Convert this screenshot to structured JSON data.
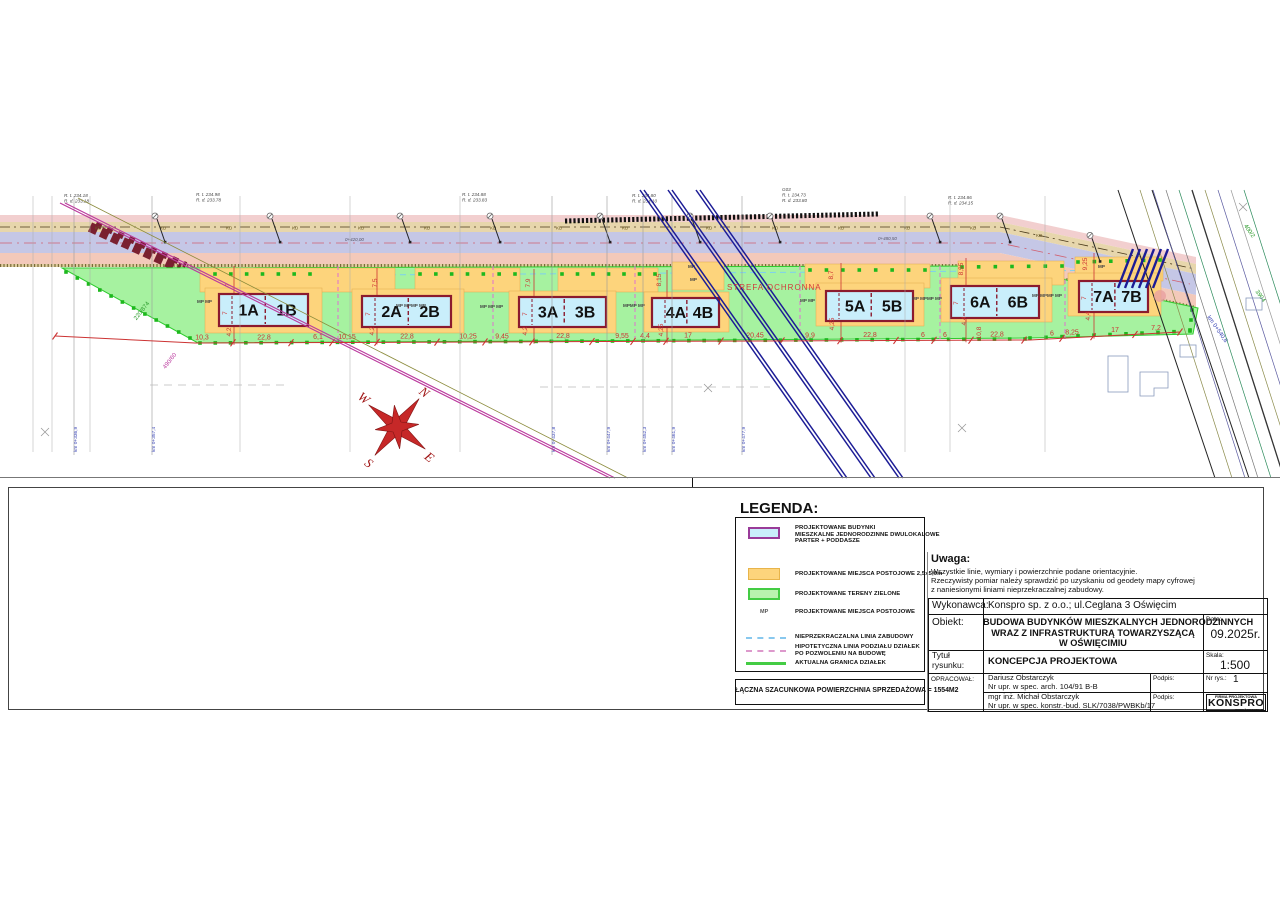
{
  "uwaga": {
    "title": "Uwaga:",
    "l1": "Wszystkie linie, wymiary i powierzchnie podane orientacyjnie.",
    "l2": "Rzeczywisty pomiar należy sprawdzić po uzyskaniu od geodety mapy cyfrowej",
    "l3": "z naniesionymi liniami nieprzekraczalnej zabudowy."
  },
  "legend": {
    "title": "LEGENDA:",
    "item1": {
      "l1": "PROJEKTOWANE BUDYNKI",
      "l2": "MIESZKALNE JEDNORODZINNE DWULOKALOWE",
      "l3": "PARTER + PODDASZE"
    },
    "item2": "PROJEKTOWANE MIEJSCA POSTOJOWE 2,5x5,0m",
    "item3": "PROJEKTOWANE TERENY ZIELONE",
    "mp_symbol": "MP",
    "item4": "PROJEKTOWANE MIEJSCA POSTOJOWE",
    "item5": "NIEPRZEKRACZALNA LINIA ZABUDOWY",
    "item6l1": "HIPOTETYCZNA LINIA PODZIAŁU DZIAŁEK",
    "item6l2": "PO POZWOLENIU NA BUDOWĘ",
    "item7": "AKTUALNA GRANICA DZIAŁEK",
    "sum": "ŁĄCZNA SZACUNKOWA POWIERZCHNIA SPRZEDAŻOWA = 1554M2",
    "colors": {
      "building": "#c9eefb",
      "building_border": "#993b99",
      "parking": "#fdd47c",
      "green": "#b9f2ae"
    }
  },
  "tb": {
    "wykonawca_label": "Wykonawca:",
    "wykonawca_value": "Konspro sp. z o.o.; ul.Ceglana 3 Oświęcim",
    "obiekt_label": "Obiekt:",
    "obiekt_lines": [
      "BUDOWA BUDYNKÓW MIESZKALNYCH JEDNORODZINNYCH",
      "WRAZ Z INFRASTRUKTURĄ TOWARZYSZĄCĄ",
      "W OŚWIĘCIMIU"
    ],
    "data_label": "Data:",
    "data_value": "09.2025r.",
    "tytul_label_1": "Tytuł",
    "tytul_label_2": "rysunku:",
    "tytul_value": "KONCEPCJA PROJEKTOWA",
    "skala_label": "Skala:",
    "skala_value": "1:500",
    "opracowal_label": "OPRACOWAŁ:",
    "author1_name": "Dariusz Obstarczyk",
    "author1_upr": "Nr upr. w spec. arch. 104/91 B-B",
    "author2_name": "mgr inż. Michał Obstarczyk",
    "author2_upr": "Nr upr. w spec. konstr.-bud. SLK/7038/PWBKb/17",
    "podpis_label": "Podpis:",
    "nr_rys_label": "Nr rys.:",
    "nr_rys_value": "1",
    "logo_top": "FIRMA PROJEKTOWA",
    "logo_name": "KONSPRO",
    "logo_site": "www.konspro.pl"
  },
  "plan": {
    "labels": {
      "strefa": "STREFA OCHRONNA"
    },
    "compass": {
      "n": "N",
      "e": "E",
      "s": "S",
      "w": "W"
    },
    "kd_label": "KD",
    "kd_xs": [
      95,
      160,
      226,
      292,
      358,
      424,
      490,
      556,
      622,
      706,
      772,
      838,
      904,
      970,
      1036
    ],
    "dim_chain": [
      {
        "t": "10,3",
        "x": 202
      },
      {
        "t": "22,8",
        "x": 264
      },
      {
        "t": "6,1",
        "x": 318
      },
      {
        "t": "10,15",
        "x": 347
      },
      {
        "t": "22,8",
        "x": 407
      },
      {
        "t": "10,25",
        "x": 468
      },
      {
        "t": "9,45",
        "x": 502
      },
      {
        "t": "22,8",
        "x": 563
      },
      {
        "t": "9,55",
        "x": 622
      },
      {
        "t": "4,4",
        "x": 645
      },
      {
        "t": "17",
        "x": 688
      },
      {
        "t": "20,45",
        "x": 755
      },
      {
        "t": "9,9",
        "x": 810
      },
      {
        "t": "22,8",
        "x": 870
      },
      {
        "t": "6",
        "x": 923
      },
      {
        "t": "6",
        "x": 945
      },
      {
        "t": "22,8",
        "x": 997
      },
      {
        "t": "6",
        "x": 1052
      },
      {
        "t": "8,25",
        "x": 1072
      },
      {
        "t": "17",
        "x": 1115
      },
      {
        "t": "7,2",
        "x": 1156
      }
    ],
    "dim_ticks": [
      55,
      233,
      291,
      332,
      377,
      437,
      485,
      532,
      592,
      633,
      666,
      721,
      782,
      840,
      896,
      934,
      971,
      1024,
      1062,
      1093,
      1135,
      1180
    ],
    "vert_dims": [
      {
        "t": "7",
        "x": 230,
        "y": 285
      },
      {
        "t": "4,2",
        "x": 231,
        "y": 332
      },
      {
        "t": "7",
        "x": 227,
        "y": 313
      },
      {
        "t": "7,5",
        "x": 377,
        "y": 283
      },
      {
        "t": "4,2",
        "x": 374,
        "y": 331
      },
      {
        "t": "7",
        "x": 370,
        "y": 314
      },
      {
        "t": "7,9",
        "x": 530,
        "y": 283
      },
      {
        "t": "4,2",
        "x": 527,
        "y": 331
      },
      {
        "t": "7",
        "x": 527,
        "y": 314
      },
      {
        "t": "8,15",
        "x": 661,
        "y": 280
      },
      {
        "t": "4,25",
        "x": 663,
        "y": 330
      },
      {
        "t": "8,7",
        "x": 833,
        "y": 275
      },
      {
        "t": "4,25",
        "x": 834,
        "y": 324
      },
      {
        "t": "8,95",
        "x": 963,
        "y": 269
      },
      {
        "t": "4,4",
        "x": 966,
        "y": 321
      },
      {
        "t": "10,8",
        "x": 981,
        "y": 333
      },
      {
        "t": "7",
        "x": 958,
        "y": 303
      },
      {
        "t": "9,25",
        "x": 1087,
        "y": 264
      },
      {
        "t": "4,4",
        "x": 1090,
        "y": 316
      },
      {
        "t": "7",
        "x": 1086,
        "y": 298
      }
    ],
    "mp_labels": [
      {
        "t": "MP MP",
        "x": 197,
        "y": 303
      },
      {
        "t": "MP MPMP MP",
        "x": 396,
        "y": 307
      },
      {
        "t": "MP MP MP",
        "x": 480,
        "y": 308
      },
      {
        "t": "MPMP MP",
        "x": 623,
        "y": 307
      },
      {
        "t": "MP",
        "x": 688,
        "y": 268
      },
      {
        "t": "MP",
        "x": 690,
        "y": 281
      },
      {
        "t": "MP MP",
        "x": 800,
        "y": 302
      },
      {
        "t": "MP MPMP MP",
        "x": 912,
        "y": 300
      },
      {
        "t": "MP MPMP MP",
        "x": 1032,
        "y": 297
      },
      {
        "t": "MP",
        "x": 1098,
        "y": 268
      }
    ],
    "buildings": [
      {
        "a": "1A",
        "b": "1B",
        "x": 219,
        "y": 294,
        "w": 89,
        "h": 32
      },
      {
        "a": "2A",
        "b": "2B",
        "x": 362,
        "y": 296,
        "w": 89,
        "h": 31
      },
      {
        "a": "3A",
        "b": "3B",
        "x": 519,
        "y": 297,
        "w": 87,
        "h": 30
      },
      {
        "a": "4A",
        "b": "4B",
        "x": 652,
        "y": 298,
        "w": 67,
        "h": 29
      },
      {
        "a": "5A",
        "b": "5B",
        "x": 826,
        "y": 291,
        "w": 87,
        "h": 30
      },
      {
        "a": "6A",
        "b": "6B",
        "x": 951,
        "y": 286,
        "w": 88,
        "h": 32
      },
      {
        "a": "7A",
        "b": "7B",
        "x": 1079,
        "y": 281,
        "w": 69,
        "h": 31
      }
    ],
    "pink_dividers": [
      338,
      493,
      635,
      800,
      940,
      1065
    ],
    "survey_points": [
      155,
      270,
      400,
      490,
      600,
      690,
      770,
      930,
      1000,
      1090
    ],
    "survey_labels": [
      {
        "x": 64,
        "y": 197,
        "lines": [
          "R. t. 234.18",
          "R. d. 233.18"
        ]
      },
      {
        "x": 196,
        "y": 196,
        "lines": [
          "R. t. 234.98",
          "R. d. 233.78"
        ]
      },
      {
        "x": 462,
        "y": 196,
        "lines": [
          "R. t. 234.88",
          "R. d. 233.83"
        ]
      },
      {
        "x": 632,
        "y": 197,
        "lines": [
          "R. t. 234.80",
          "R. d. 234.10"
        ]
      },
      {
        "x": 782,
        "y": 191,
        "lines": [
          "G03",
          "R. t. 234.73",
          "R. d. 233.80"
        ]
      },
      {
        "x": 948,
        "y": 199,
        "lines": [
          "R. t. 234.86",
          "R. d. 234.15"
        ]
      }
    ],
    "station_labels": [
      {
        "t": "0+420,00",
        "x": 345,
        "y": 241
      },
      {
        "t": "0+480,50",
        "x": 878,
        "y": 240
      }
    ],
    "km_sections": [
      {
        "t": "km 0+336,9",
        "x": 74
      },
      {
        "t": "km 0+357,4",
        "x": 152
      },
      {
        "t": "km 0+437,8",
        "x": 552
      },
      {
        "t": "km 0+447,9",
        "x": 607
      },
      {
        "t": "km 0+452,3",
        "x": 643
      },
      {
        "t": "km 0+461,9",
        "x": 672
      },
      {
        "t": "km 0+477,9",
        "x": 742
      }
    ],
    "plain_sections": [
      33,
      52,
      90,
      240,
      350,
      460,
      905,
      950,
      1045
    ],
    "parcel_labels": [
      {
        "t": "220/874",
        "x": 143,
        "y": 312,
        "r": -52,
        "c": "#2a9a2a"
      },
      {
        "t": "490/60",
        "x": 171,
        "y": 362,
        "r": -52,
        "c": "#bb3a9e"
      },
      {
        "t": "400/2",
        "x": 1248,
        "y": 232,
        "r": 55,
        "c": "#2a9a2a"
      },
      {
        "t": "3904",
        "x": 1259,
        "y": 297,
        "r": 55,
        "c": "#2a9a2a"
      },
      {
        "t": "km 0+540,8",
        "x": 1216,
        "y": 330,
        "r": 55,
        "c": "#3a45b5"
      }
    ],
    "parking_zones": [
      [
        200,
        268,
        195,
        24
      ],
      [
        415,
        268,
        105,
        24
      ],
      [
        558,
        268,
        100,
        24
      ],
      [
        672,
        262,
        52,
        28
      ],
      [
        805,
        264,
        125,
        24
      ],
      [
        958,
        261,
        106,
        24
      ],
      [
        1075,
        257,
        88,
        24
      ],
      [
        205,
        288,
        117,
        45
      ],
      [
        352,
        289,
        112,
        44
      ],
      [
        509,
        291,
        107,
        42
      ],
      [
        644,
        292,
        85,
        40
      ],
      [
        816,
        283,
        108,
        43
      ],
      [
        941,
        278,
        111,
        44
      ],
      [
        1068,
        273,
        93,
        43
      ]
    ],
    "dot_rows": [
      [
        66,
        272,
        190,
        338,
        12
      ],
      [
        200,
        343,
        1025,
        339,
        55
      ],
      [
        1030,
        338,
        1190,
        331,
        11
      ],
      [
        215,
        274,
        310,
        274,
        7
      ],
      [
        420,
        274,
        515,
        274,
        7
      ],
      [
        562,
        274,
        655,
        274,
        7
      ],
      [
        810,
        270,
        925,
        270,
        8
      ],
      [
        962,
        267,
        1062,
        266,
        7
      ],
      [
        1078,
        262,
        1160,
        260,
        6
      ],
      [
        1192,
        310,
        1190,
        330,
        3
      ]
    ],
    "diagonals": [
      {
        "x1": 640,
        "y1": 190,
        "x2": 843,
        "y2": 478,
        "c": "#1c1c96",
        "w": 1.5
      },
      {
        "x1": 644,
        "y1": 190,
        "x2": 847,
        "y2": 478,
        "c": "#1c1c96",
        "w": 1.5
      },
      {
        "x1": 668,
        "y1": 190,
        "x2": 871,
        "y2": 478,
        "c": "#1c1c96",
        "w": 1.5
      },
      {
        "x1": 672,
        "y1": 190,
        "x2": 875,
        "y2": 478,
        "c": "#1c1c96",
        "w": 1.5
      },
      {
        "x1": 696,
        "y1": 190,
        "x2": 899,
        "y2": 478,
        "c": "#1c1c96",
        "w": 1.5
      },
      {
        "x1": 700,
        "y1": 190,
        "x2": 903,
        "y2": 478,
        "c": "#1c1c96",
        "w": 1.5
      },
      {
        "x1": 60,
        "y1": 203,
        "x2": 610,
        "y2": 478,
        "c": "#bb3a9e",
        "w": 1.2
      },
      {
        "x1": 65,
        "y1": 203,
        "x2": 615,
        "y2": 478,
        "c": "#bb3a9e",
        "w": 1.2
      },
      {
        "x1": 78,
        "y1": 198,
        "x2": 628,
        "y2": 478,
        "c": "#8a8a3a",
        "w": 0.8
      },
      {
        "x1": 1118,
        "y1": 190,
        "x2": 1215,
        "y2": 478,
        "c": "#222222",
        "w": 1
      },
      {
        "x1": 1152,
        "y1": 190,
        "x2": 1249,
        "y2": 478,
        "c": "#222222",
        "w": 1
      },
      {
        "x1": 1140,
        "y1": 190,
        "x2": 1232,
        "y2": 478,
        "c": "#8a8a4a",
        "w": 0.7
      },
      {
        "x1": 1153,
        "y1": 190,
        "x2": 1245,
        "y2": 478,
        "c": "#5a5aa0",
        "w": 0.7
      },
      {
        "x1": 1166,
        "y1": 190,
        "x2": 1258,
        "y2": 478,
        "c": "#777777",
        "w": 0.7
      },
      {
        "x1": 1179,
        "y1": 190,
        "x2": 1271,
        "y2": 478,
        "c": "#2a8a5a",
        "w": 0.7
      },
      {
        "x1": 1192,
        "y1": 190,
        "x2": 1284,
        "y2": 478,
        "c": "#333333",
        "w": 1.3
      },
      {
        "x1": 1205,
        "y1": 190,
        "x2": 1297,
        "y2": 478,
        "c": "#8a8a4a",
        "w": 0.7
      },
      {
        "x1": 1218,
        "y1": 190,
        "x2": 1310,
        "y2": 478,
        "c": "#5a5aa0",
        "w": 0.7
      },
      {
        "x1": 1231,
        "y1": 190,
        "x2": 1323,
        "y2": 478,
        "c": "#999999",
        "w": 0.7
      },
      {
        "x1": 1244,
        "y1": 190,
        "x2": 1336,
        "y2": 478,
        "c": "#2a8a5a",
        "w": 0.7
      }
    ],
    "crosses": [
      [
        45,
        432
      ],
      [
        708,
        388
      ],
      [
        962,
        428
      ],
      [
        1243,
        207
      ]
    ]
  }
}
